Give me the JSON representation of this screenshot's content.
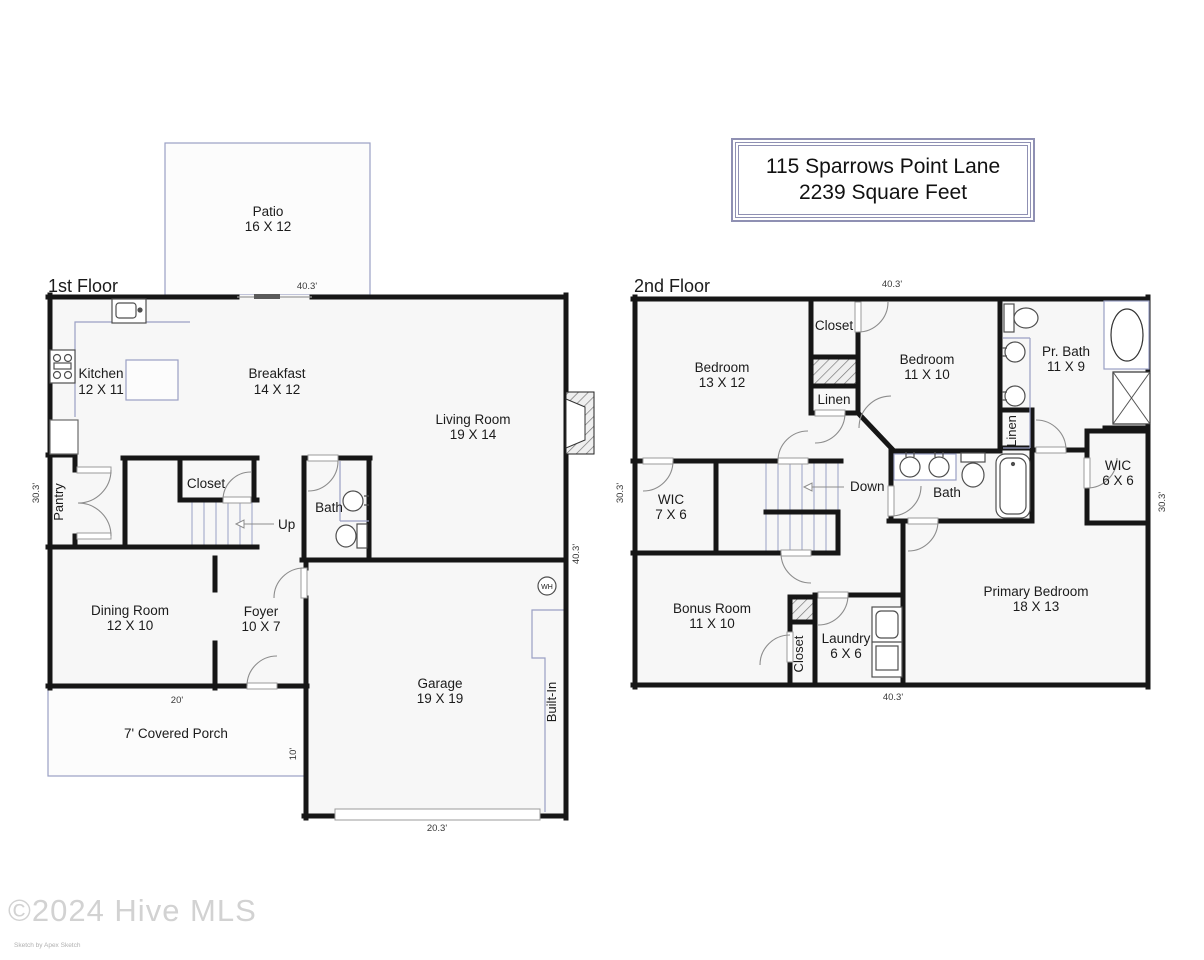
{
  "title_box": {
    "line1": "115 Sparrows Point Lane",
    "line2": "2239 Square Feet"
  },
  "floor1": {
    "label": "1st Floor",
    "rooms": {
      "patio": {
        "name": "Patio",
        "size": "16 X 12"
      },
      "kitchen": {
        "name": "Kitchen",
        "size": "12 X 11"
      },
      "breakfast": {
        "name": "Breakfast",
        "size": "14 X 12"
      },
      "living_room": {
        "name": "Living Room",
        "size": "19 X 14"
      },
      "closet": {
        "name": "Closet"
      },
      "bath": {
        "name": "Bath"
      },
      "pantry": {
        "name": "Pantry"
      },
      "dining_room": {
        "name": "Dining Room",
        "size": "12 X 10"
      },
      "foyer": {
        "name": "Foyer",
        "size": "10 X 7"
      },
      "garage": {
        "name": "Garage",
        "size": "19 X 19"
      },
      "covered_porch": {
        "name": "7' Covered Porch"
      },
      "built_in": {
        "name": "Built-In"
      }
    },
    "annotations": {
      "up": "Up",
      "water_heater": "WH"
    },
    "dims": {
      "top": "40.3'",
      "left": "30.3'",
      "right": "40.3'",
      "porch_width": "20'",
      "porch_depth": "10'",
      "garage_width": "20.3'"
    }
  },
  "floor2": {
    "label": "2nd Floor",
    "rooms": {
      "bedroom_13x12": {
        "name": "Bedroom",
        "size": "13 X 12"
      },
      "closet_top": {
        "name": "Closet"
      },
      "bedroom_11x10": {
        "name": "Bedroom",
        "size": "11 X 10"
      },
      "primary_bath": {
        "name": "Pr. Bath",
        "size": "11 X 9"
      },
      "linen_hall": {
        "name": "Linen"
      },
      "linen_bath": {
        "name": "Linen"
      },
      "wic_7x6": {
        "name": "WIC",
        "size": "7 X 6"
      },
      "bath": {
        "name": "Bath"
      },
      "wic_6x6": {
        "name": "WIC",
        "size": "6 X 6"
      },
      "bonus_room": {
        "name": "Bonus Room",
        "size": "11 X 10"
      },
      "laundry": {
        "name": "Laundry",
        "size": "6 X 6"
      },
      "closet_bottom": {
        "name": "Closet"
      },
      "primary_bedroom": {
        "name": "Primary Bedroom",
        "size": "18 X 13"
      }
    },
    "annotations": {
      "down": "Down"
    },
    "dims": {
      "top": "40.3'",
      "left": "30.3'",
      "right": "30.3'",
      "bottom": "40.3'"
    }
  },
  "watermark": {
    "copyright": "©2024 Hive MLS",
    "credit": "Sketch by Apex Sketch"
  }
}
